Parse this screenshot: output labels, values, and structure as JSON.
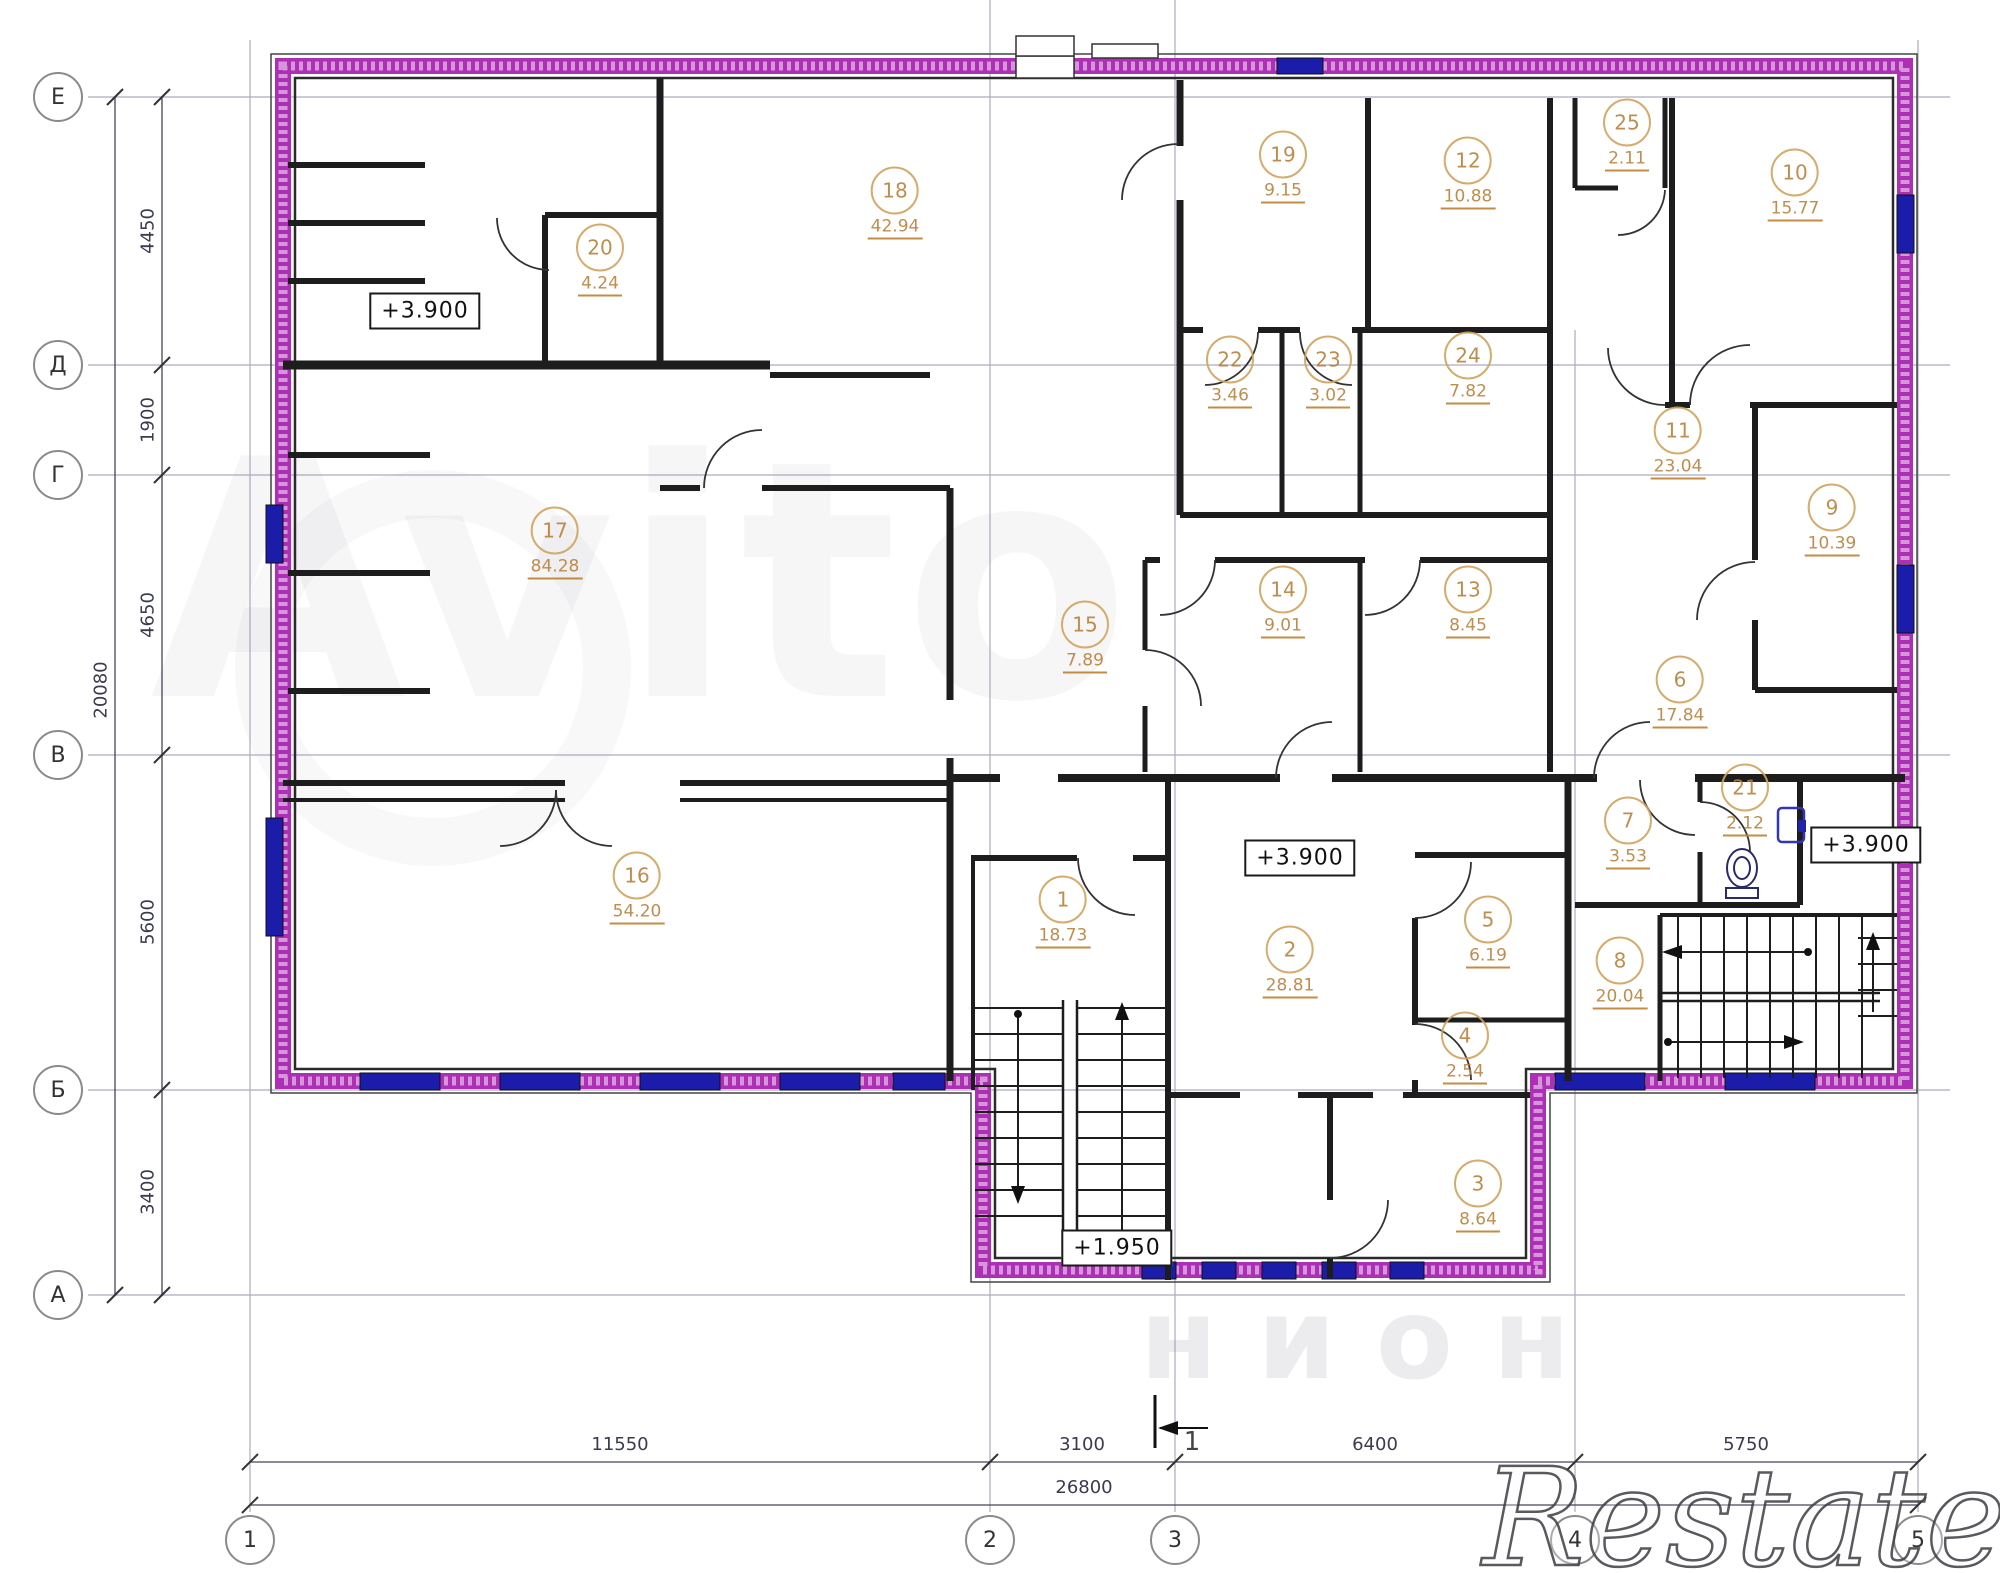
{
  "plan": {
    "rooms": [
      {
        "number": "1",
        "area": "18.73"
      },
      {
        "number": "2",
        "area": "28.81"
      },
      {
        "number": "3",
        "area": "8.64"
      },
      {
        "number": "4",
        "area": "2.54"
      },
      {
        "number": "5",
        "area": "6.19"
      },
      {
        "number": "6",
        "area": "17.84"
      },
      {
        "number": "7",
        "area": "3.53"
      },
      {
        "number": "8",
        "area": "20.04"
      },
      {
        "number": "9",
        "area": "10.39"
      },
      {
        "number": "10",
        "area": "15.77"
      },
      {
        "number": "11",
        "area": "23.04"
      },
      {
        "number": "12",
        "area": "10.88"
      },
      {
        "number": "13",
        "area": "8.45"
      },
      {
        "number": "14",
        "area": "9.01"
      },
      {
        "number": "15",
        "area": "7.89"
      },
      {
        "number": "16",
        "area": "54.20"
      },
      {
        "number": "17",
        "area": "84.28"
      },
      {
        "number": "18",
        "area": "42.94"
      },
      {
        "number": "19",
        "area": "9.15"
      },
      {
        "number": "20",
        "area": "4.24"
      },
      {
        "number": "21",
        "area": "2.12"
      },
      {
        "number": "22",
        "area": "3.46"
      },
      {
        "number": "23",
        "area": "3.02"
      },
      {
        "number": "24",
        "area": "7.82"
      },
      {
        "number": "25",
        "area": "2.11"
      }
    ],
    "axes": {
      "rows": [
        "Е",
        "Д",
        "Г",
        "В",
        "Б",
        "А"
      ],
      "cols": [
        "1",
        "2",
        "3",
        "4",
        "5"
      ]
    },
    "dimensions": {
      "left_segments": [
        "4450",
        "1900",
        "4650",
        "5600",
        "3400"
      ],
      "left_total": "20080",
      "bottom_segments": [
        "11550",
        "3100",
        "6400",
        "5750"
      ],
      "bottom_total": "26800"
    },
    "elevation_marks": [
      "+3.900",
      "+3.900",
      "+3.900",
      "+1.950"
    ],
    "section_marker": "1",
    "colors": {
      "outer_wall": "#ad2fb5",
      "window": "#1c1caa",
      "inner_wall": "#1d1d1d",
      "room_label": "#b9813a"
    }
  },
  "watermarks": {
    "center": "Avito",
    "bottom_right": "Restate",
    "bottom_faint": "нион"
  }
}
